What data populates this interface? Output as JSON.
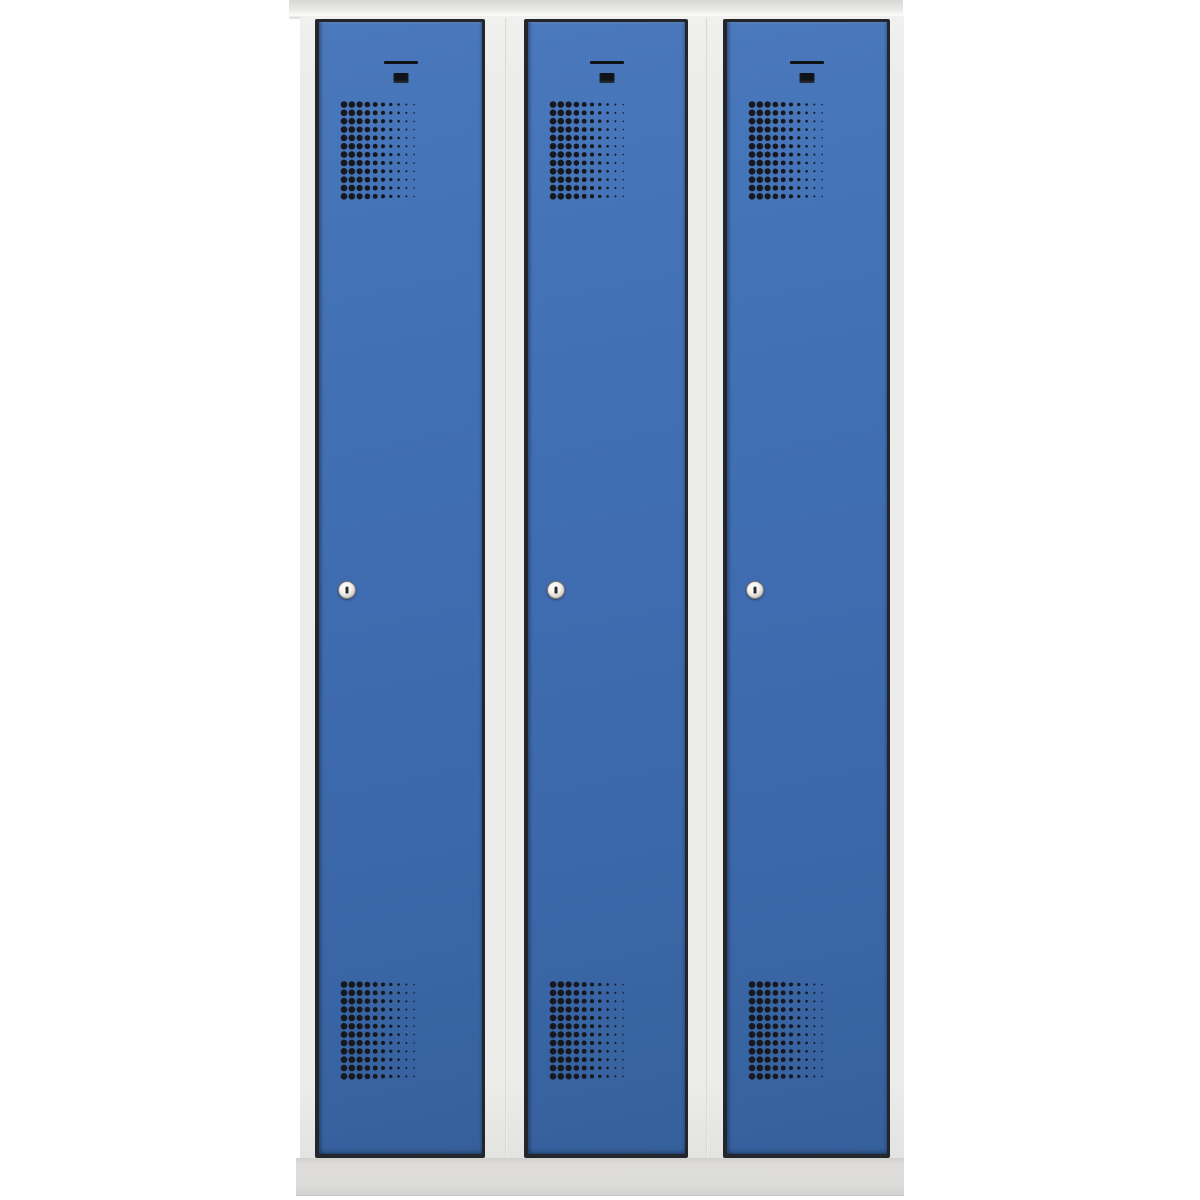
{
  "scene": {
    "type": "product-photo",
    "subject": "Steel cloakroom locker with three full-height doors",
    "background_color": "#ffffff"
  },
  "locker": {
    "door_count": 3,
    "colors": {
      "frame_grey": "#ececea",
      "top_cap_grey": "#e6e6e4",
      "base_grey": "#dcdcda",
      "door_blue": "#3f6cb0",
      "door_gap_shadow": "#23262b",
      "vent_dot": "#16181d",
      "label_slot": "#0f1217",
      "lock_ring": "#8f8c84",
      "lock_face": "#f6f5f2",
      "keyhole": "#2b2b2f"
    },
    "doors": [
      {
        "id": "door-1",
        "label_slot": true,
        "card_hole": true,
        "lock": "cylinder-lock",
        "vents": [
          "top",
          "bottom"
        ]
      },
      {
        "id": "door-2",
        "label_slot": true,
        "card_hole": true,
        "lock": "cylinder-lock",
        "vents": [
          "top",
          "bottom"
        ]
      },
      {
        "id": "door-3",
        "label_slot": true,
        "card_hole": true,
        "lock": "cylinder-lock",
        "vents": [
          "top",
          "bottom"
        ]
      }
    ],
    "vent_grid": {
      "rows": 12,
      "cols": 10,
      "dx": 7.8,
      "dy": 8.35,
      "dot_diameters": [
        6.6,
        6.6,
        6.2,
        5.6,
        4.9,
        4.1,
        3.3,
        2.6,
        2.0,
        1.5
      ]
    }
  }
}
